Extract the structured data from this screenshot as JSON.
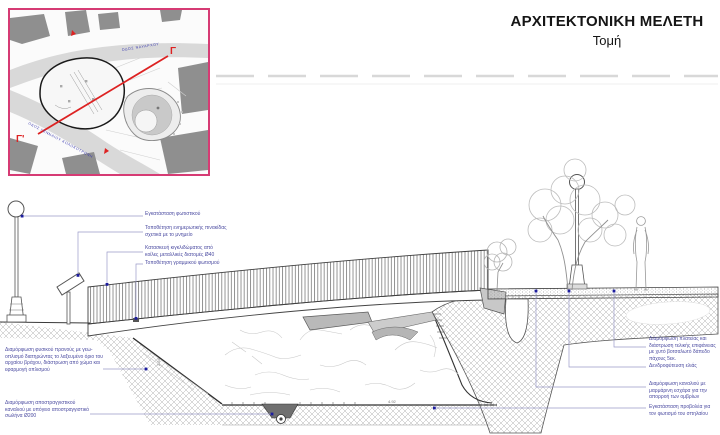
{
  "title": {
    "main": "ΑΡΧΙΤΕΚΤΟΝΙΚΗ ΜΕΛΕΤΗ",
    "sub": "Τομή"
  },
  "inset": {
    "section_start": "Γ",
    "section_end": "Γ'",
    "street_top": "ΟΔΟΣ ΝΑΥΑΡΧΟΥ",
    "street_bottom": "ΟΔΟΣ ΓΕΝΝΑΙΟΥ ΚΟΛΟΚΟΤΡΩΝΗ"
  },
  "annotations": {
    "left": [
      "Εγκατάσταση φωτιστικού",
      "Τοποθέτηση ενημερωτικής πινακίδας σχετικά με το μνημείο",
      "Κατασκευή κιγκλιδώματος από κοίλες μεταλλικές διατομές Ø40",
      "Τοποθέτηση γραμμικού φωτισμού"
    ],
    "bottom_left": [
      "Διαμόρφωση φυσικού πρανούς με γεω-οπλισμό διατηρώντας το λαξευμένο όριο του αρχαίου βράχου, διάστρωση από χώμα και εφαρμογή οπλισμού",
      "Διαμόρφωση αποστραγγιστικού καναλιού με υπόγειο αποστραγγιστικό σωλήνα Ø200"
    ],
    "right": [
      "Διαμόρφωση πλατείας και διάστρωση τελικής επιφάνειας με χυτό βοτσαλωτό δάπεδο πάχους 5εκ.",
      "Δενδροφύτευση ελιάς",
      "Διαμόρφωση καναλιού με μαρμάρινη εσχάρα για την απορροή των ομβρίων",
      "Εγκατάσταση προβολέα για τον φωτισμό του σπηλαίου"
    ],
    "dims": {
      "slope": "2.54",
      "floor": "4.92"
    }
  },
  "colors": {
    "inset_border": "#d63b74",
    "section_line_red": "#dd2222",
    "annotation_blue": "#4a4aa0",
    "leader_blue": "#9a9ac8",
    "dot_navy": "#1d1d9e"
  }
}
